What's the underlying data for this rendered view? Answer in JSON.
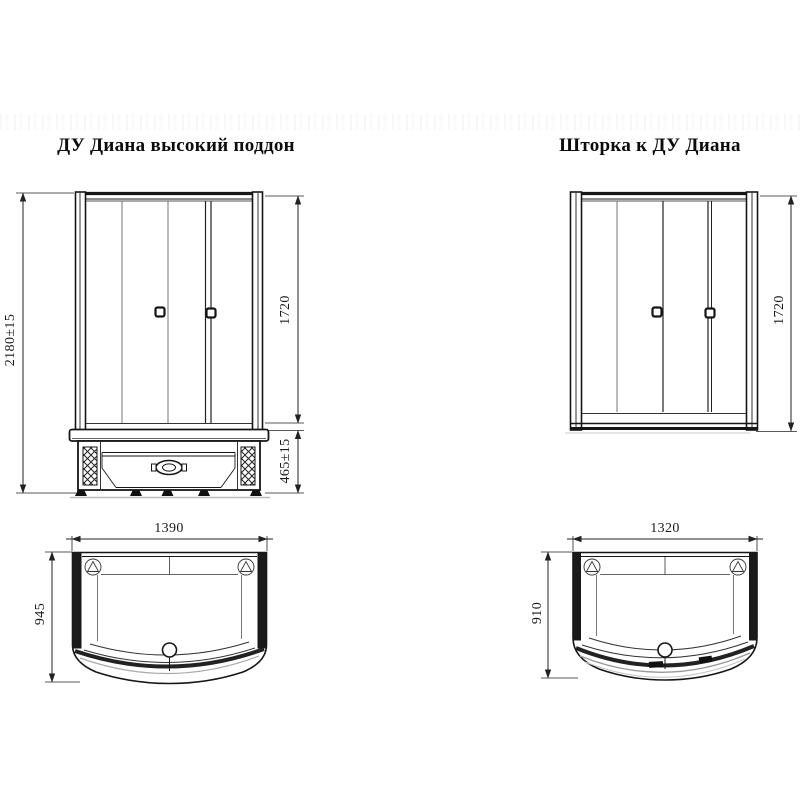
{
  "left_drawing": {
    "title": "ДУ Диана высокий поддон",
    "front_view": {
      "total_height_label": "2180±15",
      "glass_height_label": "1720",
      "tray_height_label": "465±15"
    },
    "top_view": {
      "width_label": "1390",
      "depth_label": "945"
    }
  },
  "right_drawing": {
    "title": "Шторка к ДУ Диана",
    "front_view": {
      "glass_height_label": "1720"
    },
    "top_view": {
      "width_label": "1320",
      "depth_label": "910"
    }
  },
  "colors": {
    "line": "#161616",
    "light_line": "#777777",
    "background": "#ffffff"
  }
}
